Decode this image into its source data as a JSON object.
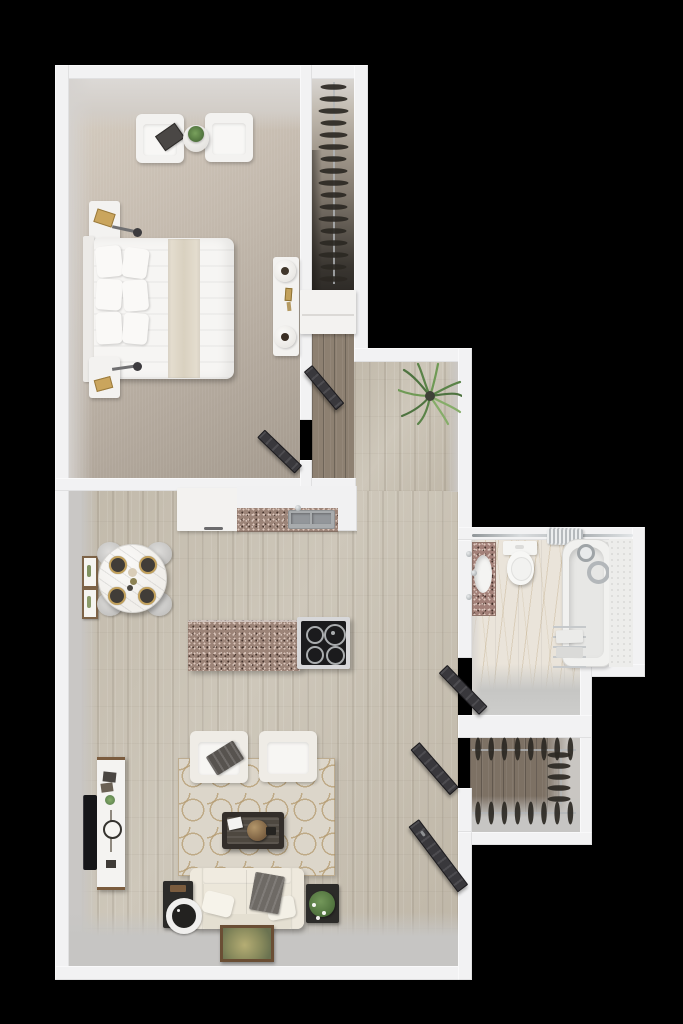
{
  "scene": {
    "description": "Top-down 3D rendered floor plan of a one-bedroom apartment on a black background",
    "style": "photoreal dollhouse render, no text labels"
  },
  "palette": {
    "bg": "#000000",
    "wall": "#f2f2f3",
    "wall-face": "#d6d3cf",
    "carpet-light": "#d7cec2",
    "carpet-dark": "#a49a8e",
    "wood-light": "#cbc4b6",
    "wood-closet": "#7d7164",
    "gray-floor": "#c2c1bf",
    "speckle": "#9c8478",
    "marble": "#eae4da",
    "tile": "#ededeb",
    "cream": "#efece6",
    "sofa": "#e9e4d8",
    "rug-base": "#dcd6ca",
    "rug-line": "#b49a6f",
    "door-dark": "#39383c",
    "espresso": "#332e2a",
    "green": "#5d8046",
    "gold": "#c2a15c",
    "chrome": "#b9bcbe",
    "cooktop": "#1b1b1d"
  },
  "counts": {
    "bedroom_closet_hangers": 17,
    "walkin_top_hangers": 8,
    "walkin_bottom_hangers": 8,
    "walkin_side_hangers": 5,
    "dining_chairs": 4,
    "dining_place_settings": 4,
    "stove_burners": 4,
    "bed_pillows": 6,
    "living_armchairs": 2,
    "bedroom_armchairs": 2
  },
  "rooms": [
    {
      "name": "bedroom",
      "floor": "beige carpet",
      "furniture": [
        "platform bed with white duvet and six pillows",
        "headboard",
        "two nightstands with swing-arm lamps and gold books",
        "two cream accent chairs",
        "round plant stand",
        "wall console with two candle trays and perfume bottles"
      ]
    },
    {
      "name": "bedroom-closet",
      "floor": "carpet fading to shadow",
      "furniture": [
        "vertical hanging rod with dark clothes hangers",
        "built-in white cabinet"
      ]
    },
    {
      "name": "hallway",
      "floor": "light oak plank",
      "furniture": [
        "potted palm plant"
      ]
    },
    {
      "name": "kitchen",
      "floor": "light oak plank",
      "furniture": [
        "white tall cabinet",
        "counter with speckled granite top and double stainless sink",
        "island with speckled top and four-burner cooktop"
      ]
    },
    {
      "name": "dining-nook",
      "floor": "light oak plank",
      "furniture": [
        "round marble table with four dark gold-rim place settings",
        "four gray round chairs",
        "two framed botanical prints"
      ]
    },
    {
      "name": "living-room",
      "floor": "light oak plank",
      "furniture": [
        "two cream armchairs",
        "cream geometric lattice rug",
        "espresso coffee table with rattan sphere",
        "cream three-seat sofa with pillows and gray throw",
        "black side table with white ring speaker",
        "black side table with white flower plant",
        "white media console with wood trim",
        "wall-mounted tv",
        "leaning framed landscape art",
        "dark entry door"
      ]
    },
    {
      "name": "bathroom",
      "floor": "marble tile",
      "furniture": [
        "speckled vanity with oval sink",
        "toilet",
        "bathtub with shower head and hand shower",
        "white tile shower wall",
        "chrome towel ladder with towels",
        "shower curtain rod with bunched curtain",
        "dark swing door"
      ]
    },
    {
      "name": "walk-in-closet",
      "floor": "dark wood plank",
      "furniture": [
        "top hanging rod with hangers",
        "bottom hanging rod with hangers",
        "side hanging rod with hangers",
        "dark swing door"
      ]
    }
  ]
}
